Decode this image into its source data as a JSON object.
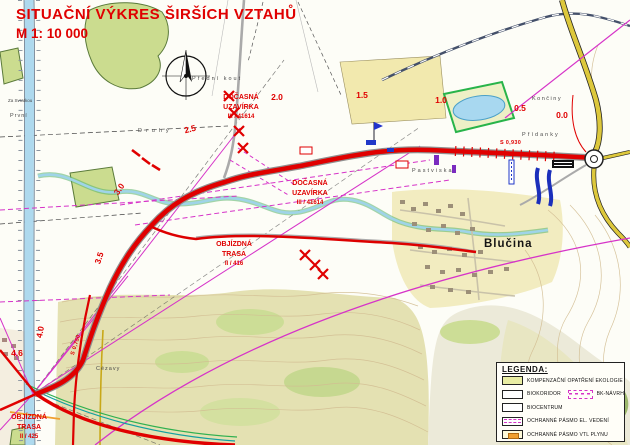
{
  "title": {
    "main": "SITUAČNÍ VÝKRES ŠIRŠÍCH VZTAHŮ",
    "scale": "M 1: 10 000"
  },
  "routes": {
    "closure_a": [
      "DOČASNÁ",
      "UZAVÍRKA",
      "III / 41614"
    ],
    "closure_b": [
      "DOČASNÁ",
      "UZAVÍRKA",
      "III / 41614"
    ],
    "detour_416": [
      "OBJÍZDNÁ",
      "TRASA",
      "II / 416"
    ],
    "detour_425": [
      "OBJÍZDNÁ",
      "TRASA",
      "II / 425"
    ]
  },
  "km": [
    "0.0",
    "0.5",
    "1.0",
    "1.5",
    "2.0",
    "2.5",
    "3.0",
    "3.5",
    "4.0",
    "4.6"
  ],
  "bridges": {
    "b1": "S 0,930",
    "b2": "S 0,750"
  },
  "places": {
    "town": "Blučina",
    "predni_kout": "Přední kout",
    "druhy": "Druhý",
    "prvni": "První",
    "za_svratkou": "Za Svratkou",
    "pridanky": "Přídanky",
    "konciny": "Končiny",
    "pastviska": "Pastviska",
    "cezavy": "Cézavy"
  },
  "legend": {
    "title": "LEGENDA:",
    "items": [
      {
        "label": "KOMPENZAČNÍ OPATŘENÍ EKOLOGIE"
      },
      {
        "label": "BIOKORIDOR",
        "extra": "BK-NÁVRH"
      },
      {
        "label": "BIOCENTRUM"
      },
      {
        "label": "OCHRANNÉ PÁSMO EL. VEDENÍ"
      },
      {
        "label": "OCHRANNÉ PÁSMO VTL PLYNU"
      }
    ]
  },
  "colors": {
    "accent_red": "#e00000",
    "magenta": "#d633c8",
    "eco_green": "#cbdc8f",
    "pond_blue": "#a8d8f0",
    "road_yellow": "#ddc83c",
    "gas_orange": "#f0a030"
  }
}
